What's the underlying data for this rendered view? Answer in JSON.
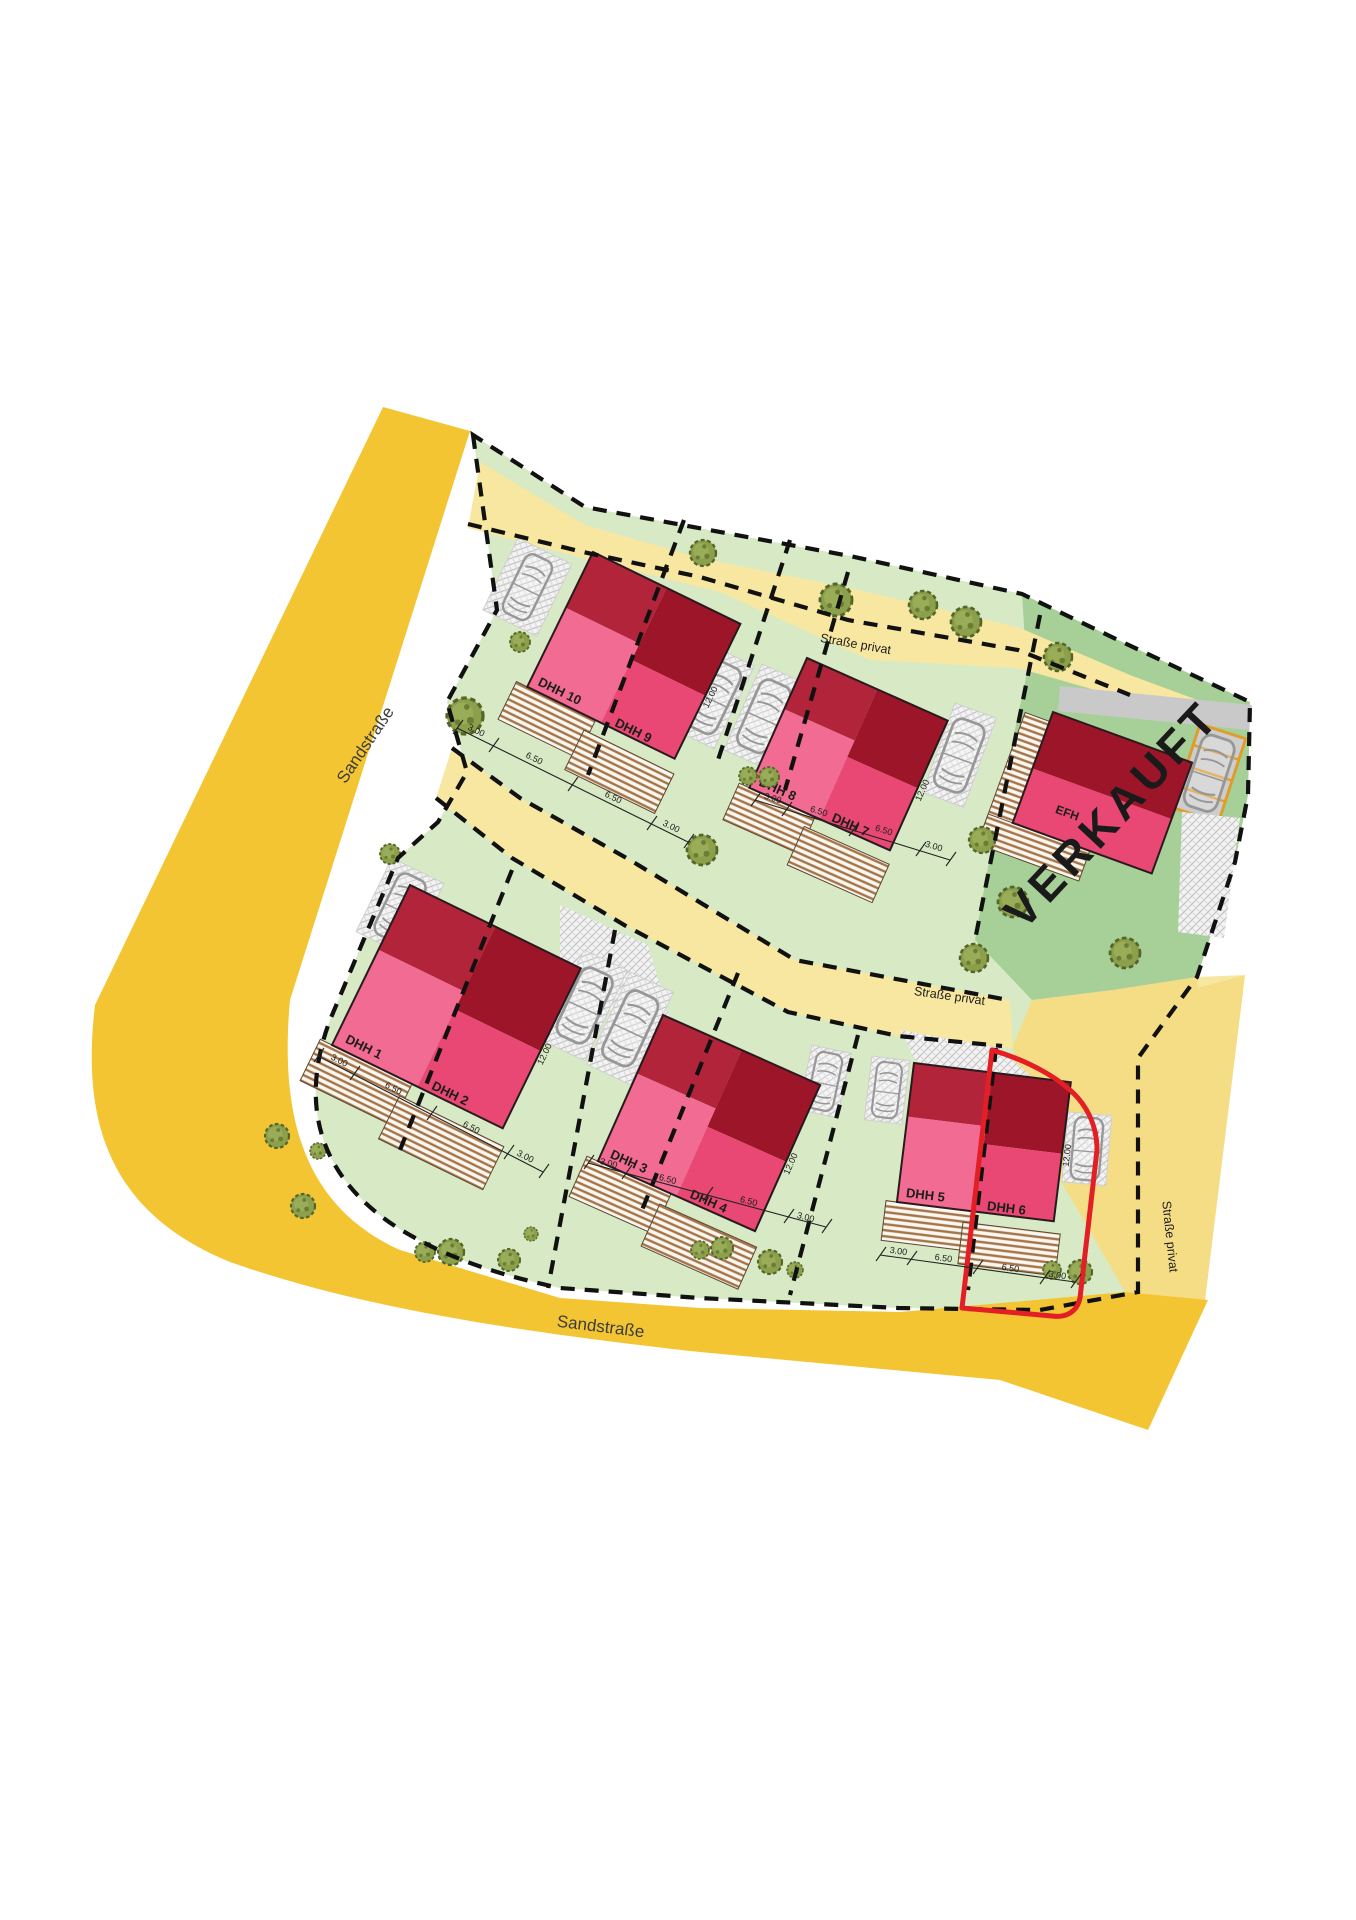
{
  "plan_type": "site-plan",
  "streets": {
    "main_left": "Sandstraße",
    "main_bottom": "Sandstraße",
    "private_top": "Straße privat",
    "private_middle": "Straße privat",
    "private_right": "Straße privat"
  },
  "houses": [
    {
      "id": "dhh-10-9",
      "left_label": "DHH 10",
      "right_label": "DHH 9"
    },
    {
      "id": "dhh-8-7",
      "left_label": "DHH 8",
      "right_label": "DHH 7"
    },
    {
      "id": "efh",
      "label": "EFH"
    },
    {
      "id": "dhh-1-2",
      "left_label": "DHH 1",
      "right_label": "DHH 2"
    },
    {
      "id": "dhh-3-4",
      "left_label": "DHH 3",
      "right_label": "DHH 4"
    },
    {
      "id": "dhh-5-6",
      "left_label": "DHH 5",
      "right_label": "DHH 6"
    }
  ],
  "overlay": {
    "sold": "VERKAUFT"
  },
  "dims": {
    "setback": "3.00",
    "unit_width": "6.50",
    "house_depth": "12.00"
  },
  "colors": {
    "main_road": "#F3C532",
    "private_road": "#F8E7A0",
    "private_road_deep": "#F5DD86",
    "plot_green": "#D7EAC5",
    "plot_green_dark": "#A6D098",
    "roof_dark_left": "#B22439",
    "roof_dark_right": "#9C1528",
    "roof_pink_left": "#F16B92",
    "roof_pink_right": "#E84873",
    "sold_plot_outline": "#E31E24",
    "boundary": "#111111",
    "carport_frame": "#DE9E2E",
    "driveway_gray": "#C9C9C9"
  }
}
